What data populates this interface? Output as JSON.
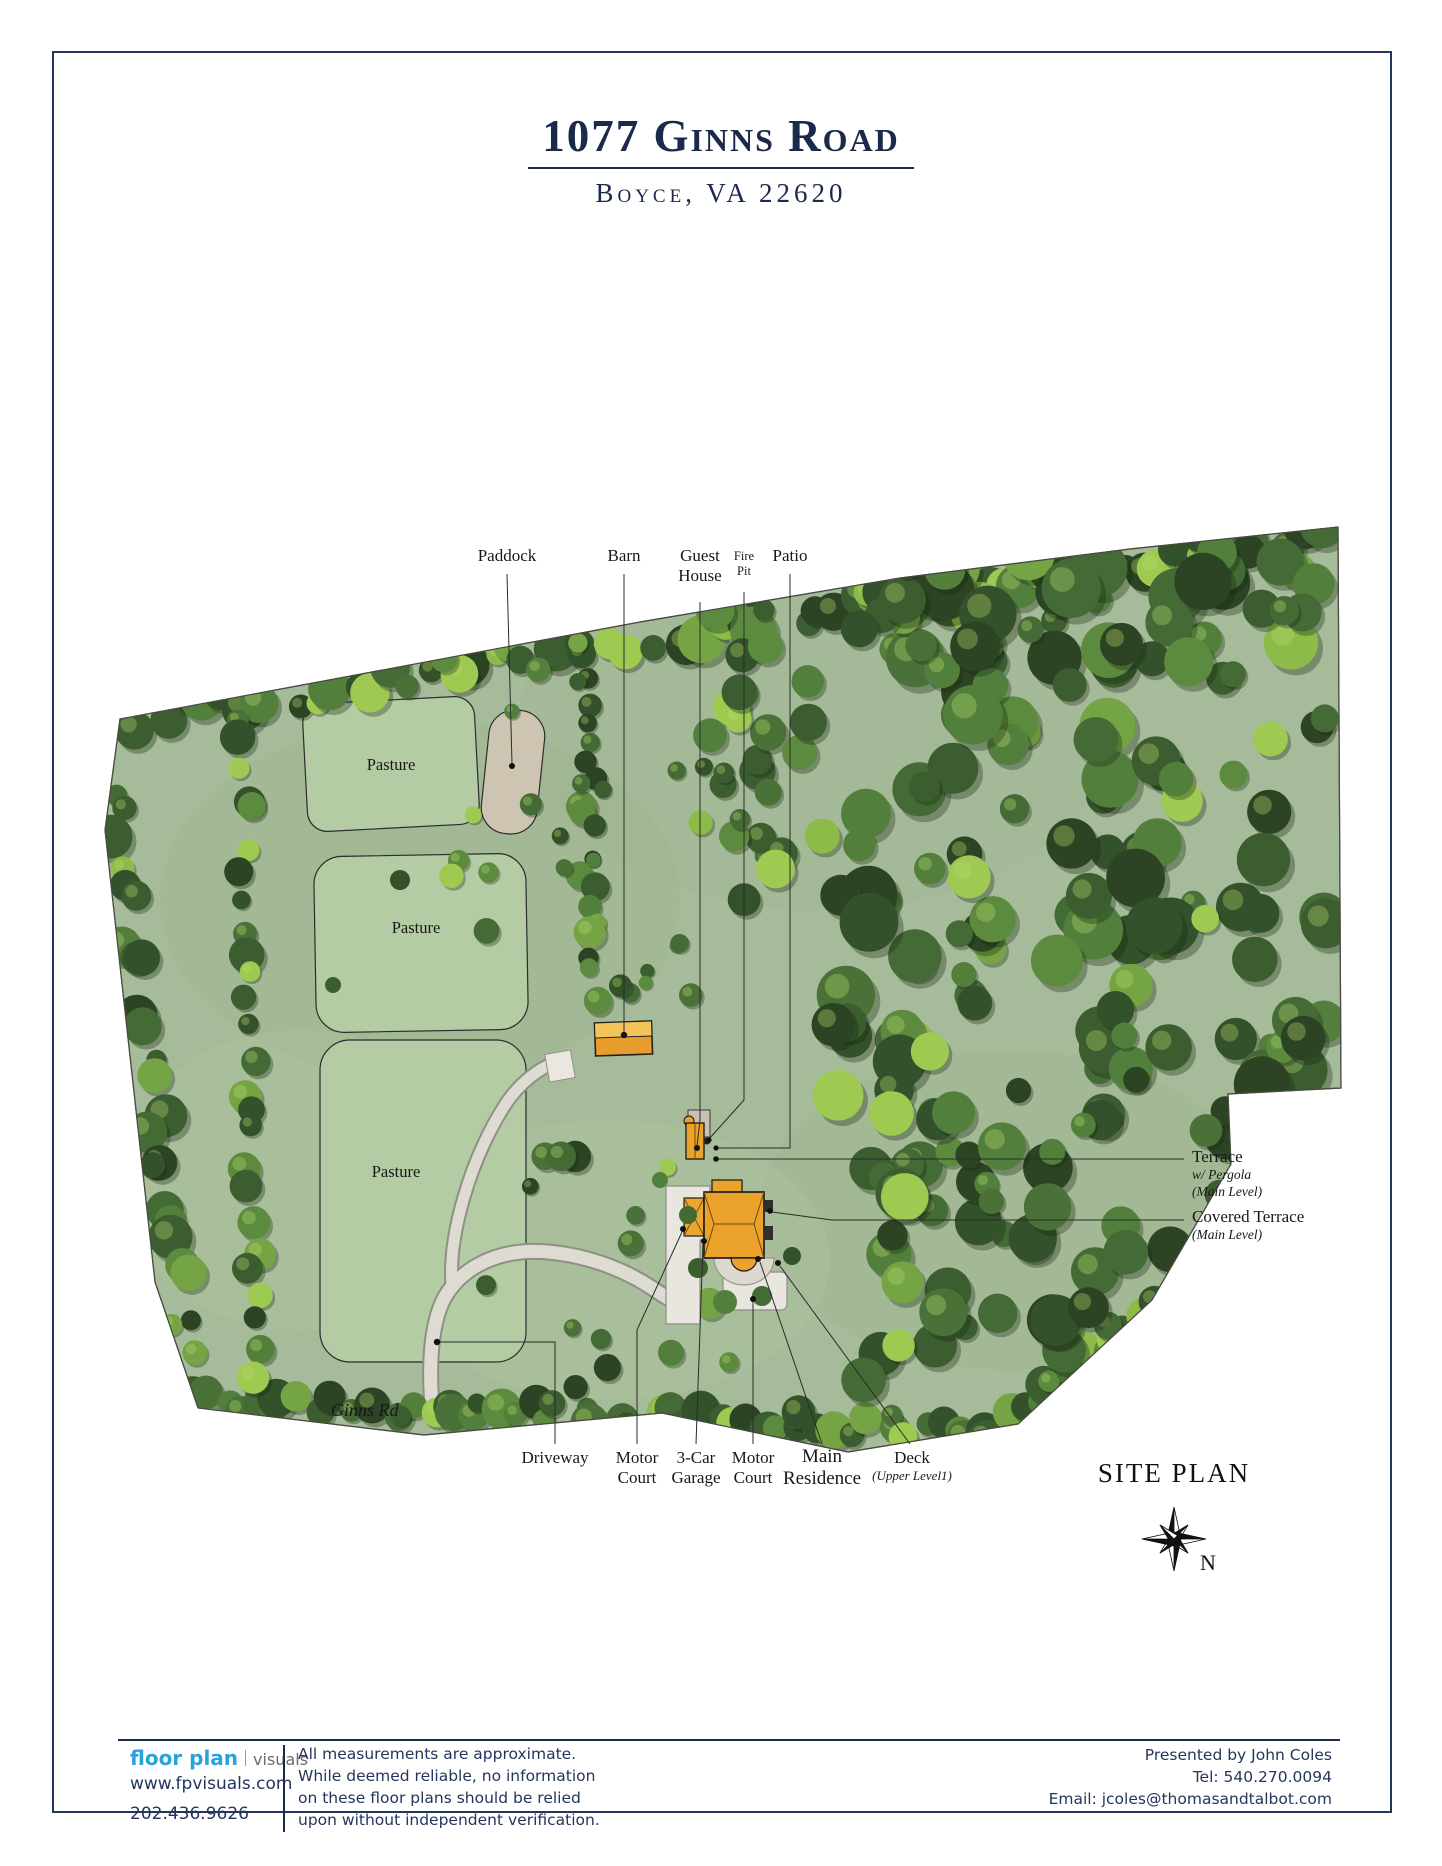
{
  "header": {
    "title": "1077 Ginns Road",
    "subtitle": "Boyce, VA 22620"
  },
  "map": {
    "drawing_title": "SITE PLAN",
    "north_indicator": "N",
    "road_label": "Ginns Rd",
    "areas": {
      "pasture_1": "Pasture",
      "pasture_2": "Pasture",
      "pasture_3": "Pasture"
    },
    "features": {
      "paddock": "Paddock",
      "barn": "Barn",
      "guest_house": "Guest House",
      "fire_pit": "Fire Pit",
      "patio": "Patio",
      "terrace": "Terrace",
      "terrace_note_1": "w/ Pergola",
      "terrace_note_2": "(Main Level)",
      "covered_terrace": "Covered Terrace",
      "covered_terrace_note": "(Main Level)",
      "driveway": "Driveway",
      "motor_court_west": "Motor Court",
      "garage": "3-Car Garage",
      "motor_court_south": "Motor Court",
      "main_residence": "Main Residence",
      "deck": "Deck",
      "deck_note": "(Upper Level1)"
    }
  },
  "footer": {
    "brand": {
      "primary": "floor plan",
      "secondary": "visuals",
      "website": "www.fpvisuals.com",
      "phone": "202.436.9626"
    },
    "disclaimer": [
      "All measurements are approximate.",
      "While deemed reliable, no information",
      "on these floor plans should be relied",
      "upon without independent verification."
    ],
    "agent": {
      "presented_by": "Presented by John Coles",
      "tel": "Tel: 540.270.0094",
      "email": "Email: jcoles@thomasandtalbot.com"
    }
  },
  "colors": {
    "accent_navy": "#1b2a4a",
    "brand_blue": "#2aa3dc",
    "map_green": "#a6bb99",
    "pasture_green": "#b4cca4",
    "paddock_tan": "#cdc5b1",
    "building_orange": "#eba22b",
    "court_gray": "#e8e6df"
  }
}
